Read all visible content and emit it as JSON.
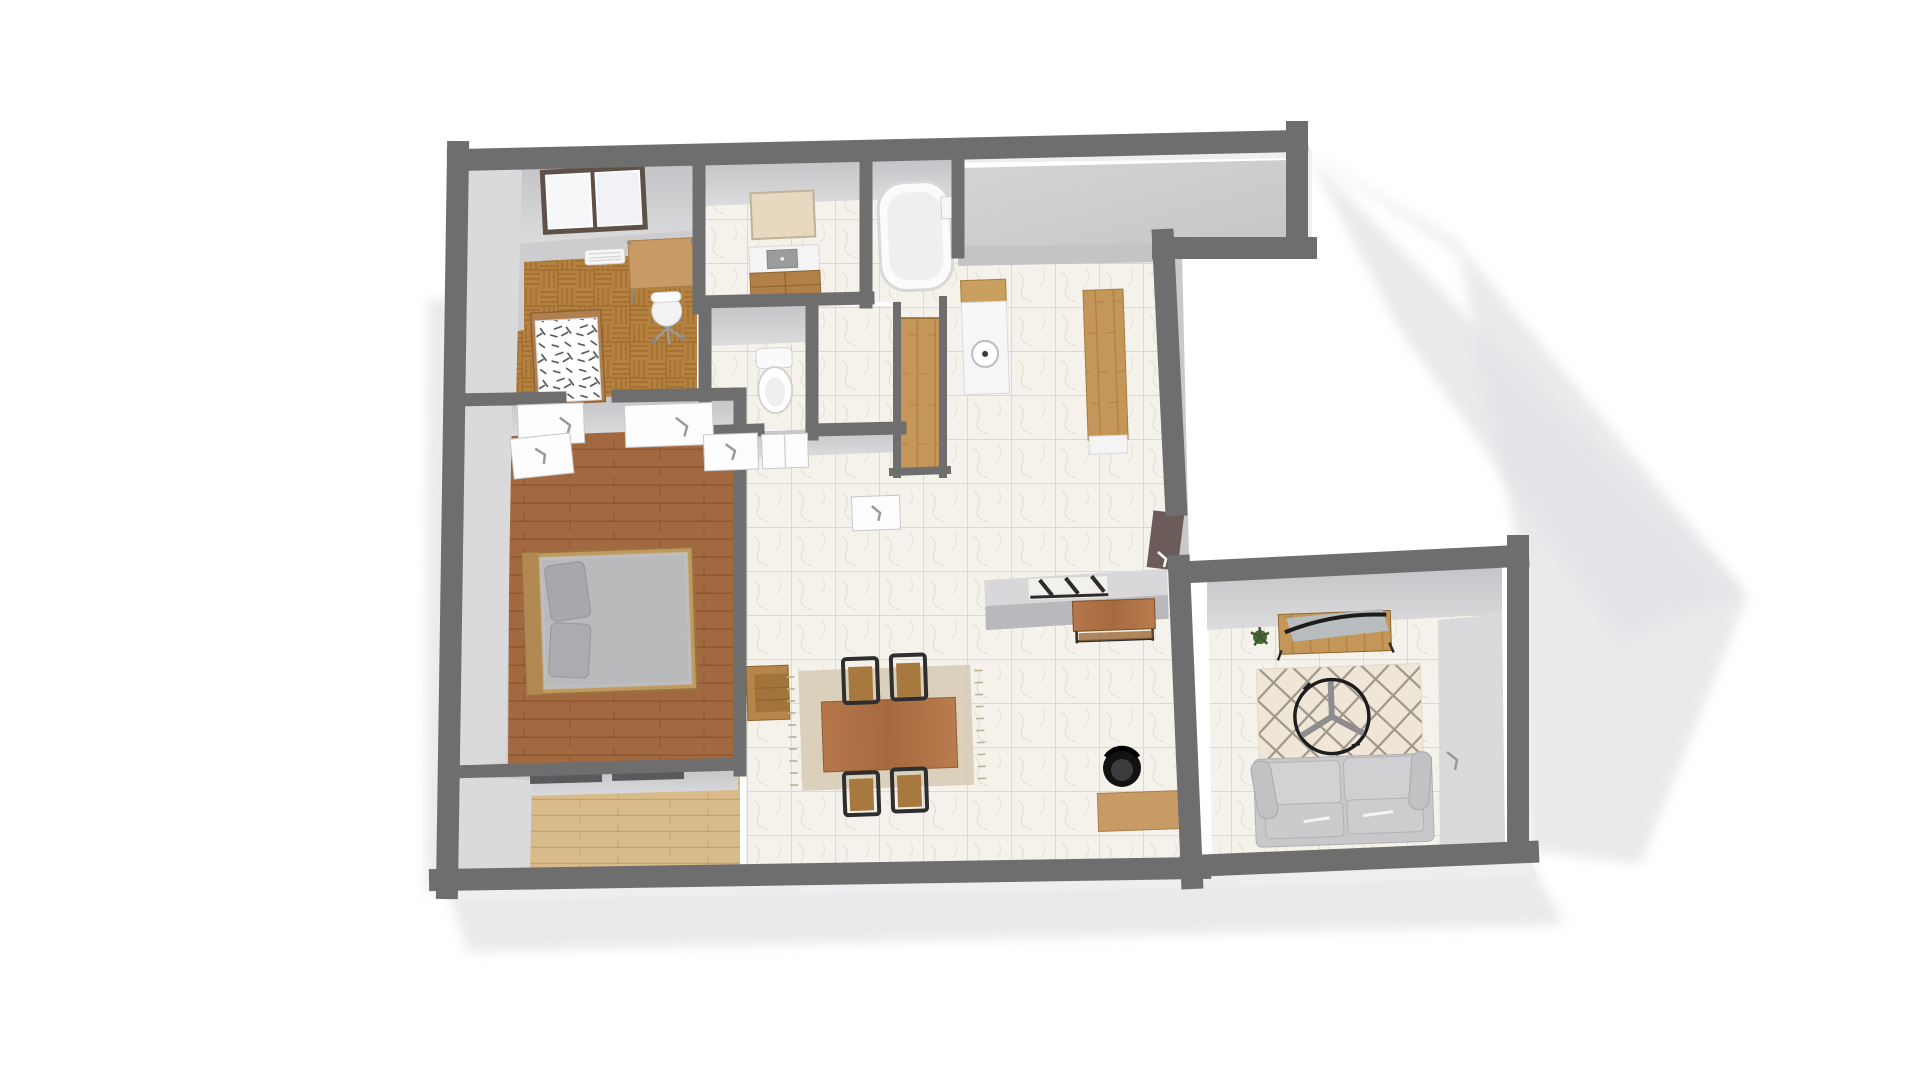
{
  "title": "3D apartment floor plan render",
  "view": {
    "type": "overhead 3d render",
    "background": "white",
    "tilt_deg": -2.5
  },
  "colors": {
    "wall": "#6e6e6e",
    "wallFace": "#c9c9cc",
    "wallFaceLight": "#dadadc",
    "grayFloor": "#cdcdd0",
    "marble": "#f5f2ec",
    "parquet": "#b5813f",
    "bedwood": "#a2683f",
    "beigewood": "#d9ba8a",
    "stripwood": "#c49758",
    "tablewood": "#b5774a",
    "accentwood": "#a8763e",
    "deskwood": "#c89b66",
    "rugBeige": "#d8cdb8",
    "rugCream": "#efe6d8",
    "rugLine": "#8a8275",
    "sofa": "#c8c8ca",
    "doorDark": "#6b5b59",
    "shadow": "#e3e3e7",
    "paper": "#ffffff",
    "mirror": "#e8d8bf"
  },
  "rooms": [
    {
      "name": "office",
      "floor": "parquet + concrete gray",
      "furniture": [
        "window",
        "wall vent",
        "desk",
        "office chair",
        "single bed with dashed duvet"
      ]
    },
    {
      "name": "bathroom",
      "floor": "marble",
      "furniture": [
        "mirror",
        "vanity with basin",
        "wood cabinet",
        "bathtub",
        "wall box"
      ]
    },
    {
      "name": "wc",
      "floor": "marble",
      "furniture": [
        "toilet",
        "door"
      ]
    },
    {
      "name": "closet-strip",
      "floor": "wood planks",
      "furniture": []
    },
    {
      "name": "kitchen",
      "floor": "marble",
      "furniture": [
        "sink counter with round sink",
        "wood counter section",
        "long wood island"
      ]
    },
    {
      "name": "master-bedroom",
      "floor": "wood planks",
      "furniture": [
        "double bed with gray duvet",
        "two gray pillows",
        "door leaf"
      ]
    },
    {
      "name": "bottom-room",
      "floor": "light wood",
      "furniture": [
        "closet sliding bars"
      ]
    },
    {
      "name": "dining-room",
      "floor": "marble",
      "furniture": [
        "wall shelf",
        "fringed rug",
        "dining table",
        "chair",
        "chair",
        "chair",
        "chair"
      ]
    },
    {
      "name": "entry-hall",
      "floor": "marble",
      "furniture": [
        "half wall",
        "coat rack with 3 hooks",
        "console table",
        "black swivel chair",
        "small desk",
        "front door leaf"
      ]
    },
    {
      "name": "living-room",
      "floor": "marble",
      "furniture": [
        "sideboard with curved screen",
        "plant",
        "diamond lattice rug",
        "round coffee table",
        "sofa"
      ]
    }
  ],
  "annotations": {
    "door_marks": "small corner arrows on door leaves",
    "shadow": "soft cast shadow to the right and below the unit"
  }
}
